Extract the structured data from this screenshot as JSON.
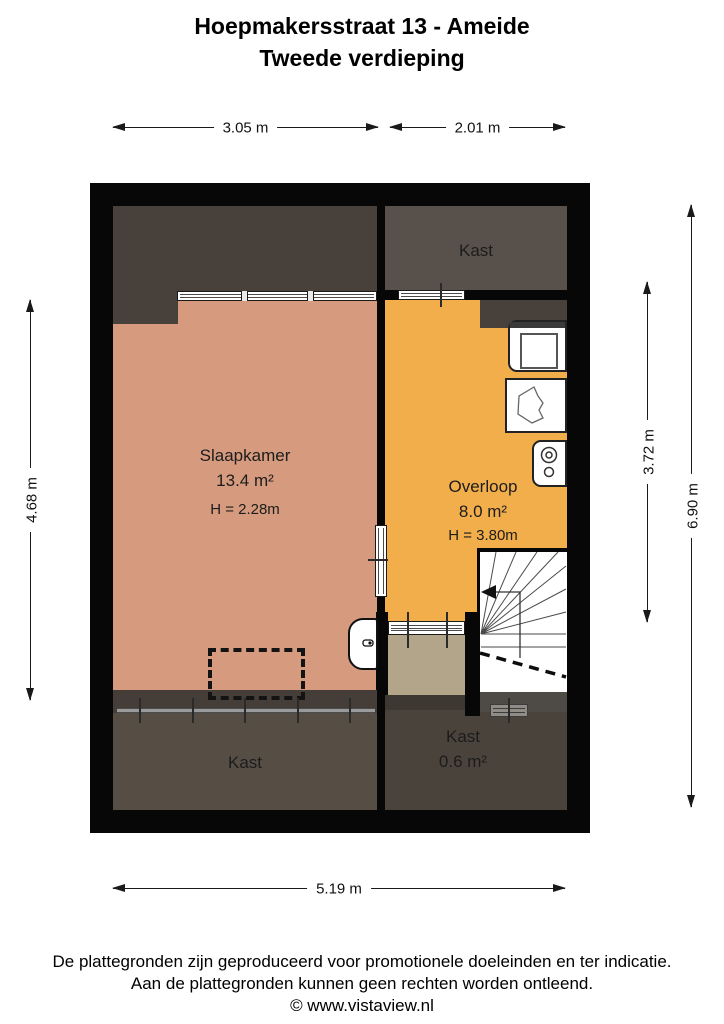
{
  "title": {
    "line1": "Hoepmakersstraat 13 - Ameide",
    "line2": "Tweede verdieping"
  },
  "dimensions": {
    "top_left": "3.05 m",
    "top_right": "2.01 m",
    "left": "4.68 m",
    "right_inner": "3.72 m",
    "right_outer": "6.90 m",
    "bottom": "5.19 m"
  },
  "rooms": {
    "slaapkamer": {
      "name": "Slaapkamer",
      "area": "13.4 m²",
      "ceiling": "H = 2.28m",
      "floor_color": "#d69b7e"
    },
    "overloop": {
      "name": "Overloop",
      "area": "8.0 m²",
      "ceiling": "H = 3.80m",
      "floor_color": "#f3ae4c"
    },
    "kast_top_right": {
      "name": "Kast",
      "floor_color": "#58514b"
    },
    "kast_bottom_left": {
      "name": "Kast",
      "floor_color": "#564e44"
    },
    "kast_bottom_middle": {
      "name": "Kast",
      "area": "0.6 m²",
      "floor_color": "#4a433c"
    },
    "kast_small_floor": {
      "floor_color": "#b3a58a"
    }
  },
  "colors": {
    "wall": "#070707",
    "roof_slope": "#48403a",
    "bottom_band": "#453d37",
    "dimension_line": "#1a1a1a",
    "window": "#ffffff"
  },
  "fixtures": {
    "washing_machine": "washing-machine",
    "sink": "sink",
    "boiler": "boiler",
    "toilet": "toilet",
    "stairs": "stairs-with-winders",
    "dormer": "dashed-dormer-outline"
  },
  "footer": {
    "line1": "De plattegronden zijn geproduceerd voor promotionele doeleinden en ter indicatie.",
    "line2": "Aan de plattegronden kunnen geen rechten worden ontleend.",
    "line3": "© www.vistaview.nl"
  }
}
